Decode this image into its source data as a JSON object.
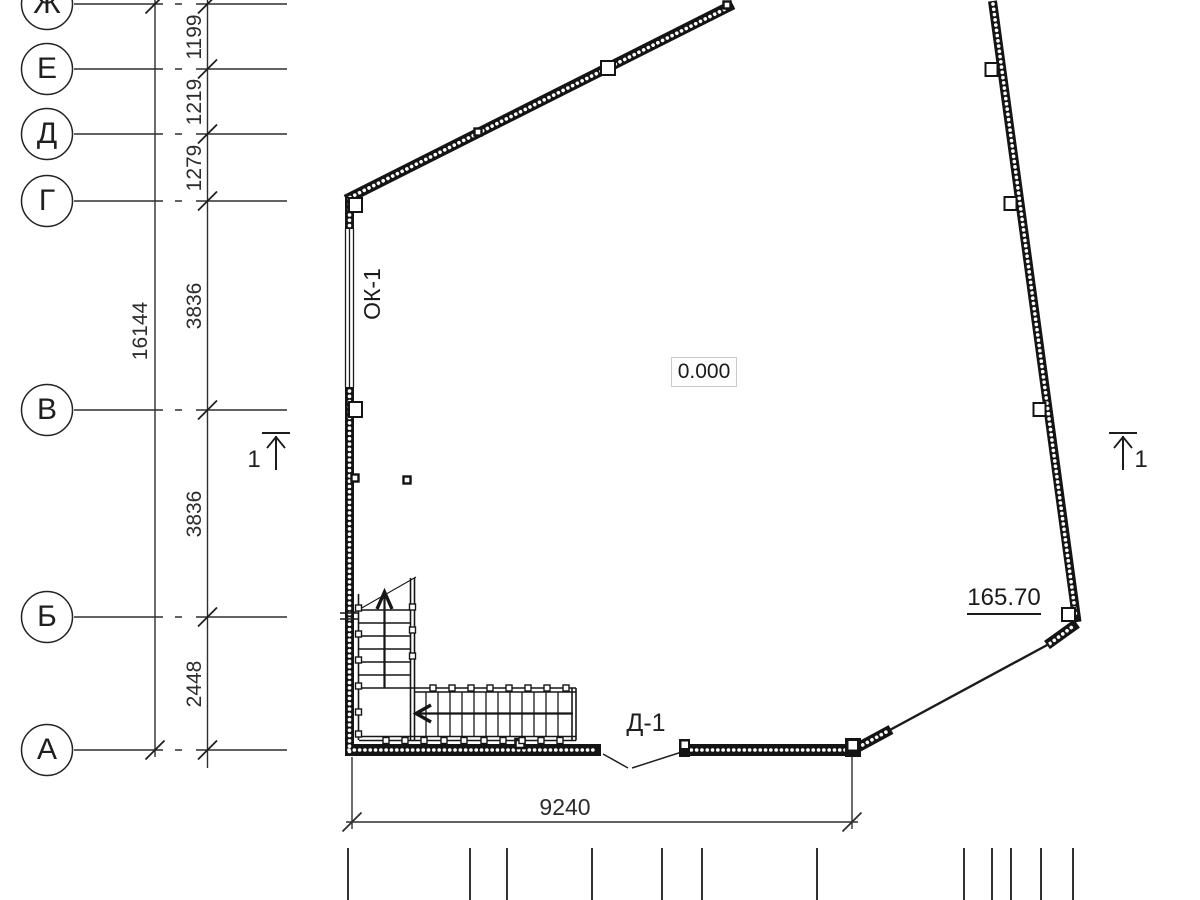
{
  "drawing_title": "first-floor-plan-fragment",
  "axes": {
    "rows": [
      {
        "label": "Ж"
      },
      {
        "label": "Е"
      },
      {
        "label": "Д"
      },
      {
        "label": "Г"
      },
      {
        "label": "В"
      },
      {
        "label": "Б"
      },
      {
        "label": "А"
      }
    ]
  },
  "dimensions": {
    "total_left": "16144",
    "left_segments": [
      "1199",
      "1219",
      "1279",
      "3836",
      "3836",
      "2448"
    ],
    "bottom_width": "9240"
  },
  "annotations": {
    "window_label": "ОК-1",
    "door_label": "Д-1",
    "floor_level": "0.000",
    "elevation_mark": "165.70",
    "section_number_left": "1",
    "section_number_right": "1"
  },
  "colors": {
    "wall": "#141414",
    "line": "#2b2b2b",
    "level_box_border": "#c9c9c9"
  }
}
